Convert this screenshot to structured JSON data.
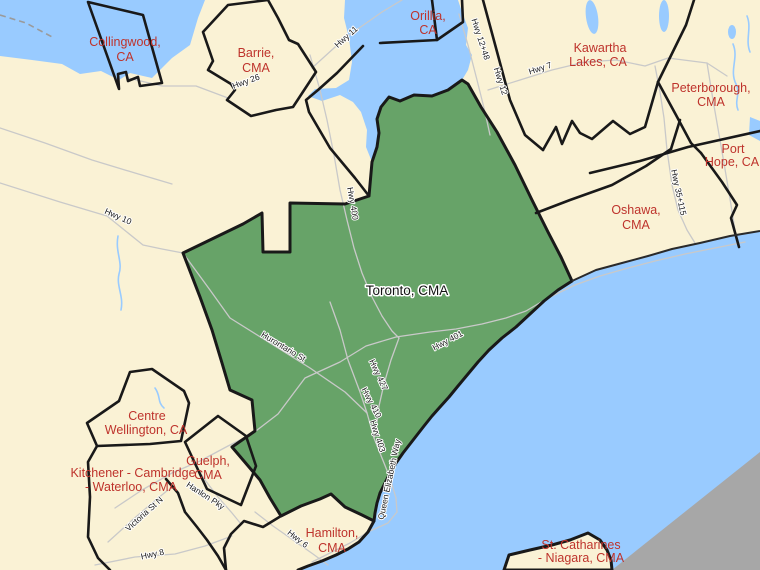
{
  "map": {
    "type": "census-metropolitan-area-reference-map",
    "selected_region": "Toronto, CMA",
    "colors": {
      "land": "#FAF2D5",
      "water": "#99CBFF",
      "selected_region_fill": "#67A368",
      "outside_area": "#A7A7A7",
      "boundary": "#191919",
      "region_label": "#BE332C",
      "selected_label": "#141414",
      "road": "#C9C9C9",
      "road_label": "#1A1A1A",
      "label_halo": "#FFFFFF"
    },
    "regions": [
      {
        "id": "collingwood",
        "line1": "Collingwood,",
        "line2": "CA"
      },
      {
        "id": "barrie",
        "line1": "Barrie,",
        "line2": "CMA"
      },
      {
        "id": "orillia",
        "line1": "Orillia,",
        "line2": "CA"
      },
      {
        "id": "kawartha-lakes",
        "line1": "Kawartha",
        "line2": "Lakes, CA"
      },
      {
        "id": "peterborough",
        "line1": "Peterborough,",
        "line2": "CMA"
      },
      {
        "id": "port-hope",
        "line1": "Port",
        "line2": "Hope, CA"
      },
      {
        "id": "oshawa",
        "line1": "Oshawa,",
        "line2": "CMA"
      },
      {
        "id": "toronto",
        "line1": "Toronto, CMA",
        "line2": ""
      },
      {
        "id": "centre-wellington",
        "line1": "Centre",
        "line2": "Wellington, CA"
      },
      {
        "id": "guelph",
        "line1": "Guelph,",
        "line2": "CMA"
      },
      {
        "id": "kitchener-cambridge-waterloo",
        "line1": "Kitchener - Cambridge",
        "line2": "- Waterloo, CMA"
      },
      {
        "id": "hamilton",
        "line1": "Hamilton,",
        "line2": "CMA"
      },
      {
        "id": "st-catharines-niagara",
        "line1": "St. Catharines",
        "line2": "- Niagara, CMA"
      }
    ],
    "roads": [
      "Hwy 11",
      "Hwy 26",
      "Hwy 12+48",
      "Hwy 12",
      "Hwy 7",
      "Hwy 10",
      "Hwy 400",
      "Hwy 401",
      "Hwy 427",
      "Hwy 410",
      "Hwy 403",
      "Queen Elizabeth Way",
      "Hurontario St",
      "Hwy 35+115",
      "Hwy 8",
      "Hwy 6",
      "Victoria St N",
      "Hanlon Pky"
    ]
  }
}
